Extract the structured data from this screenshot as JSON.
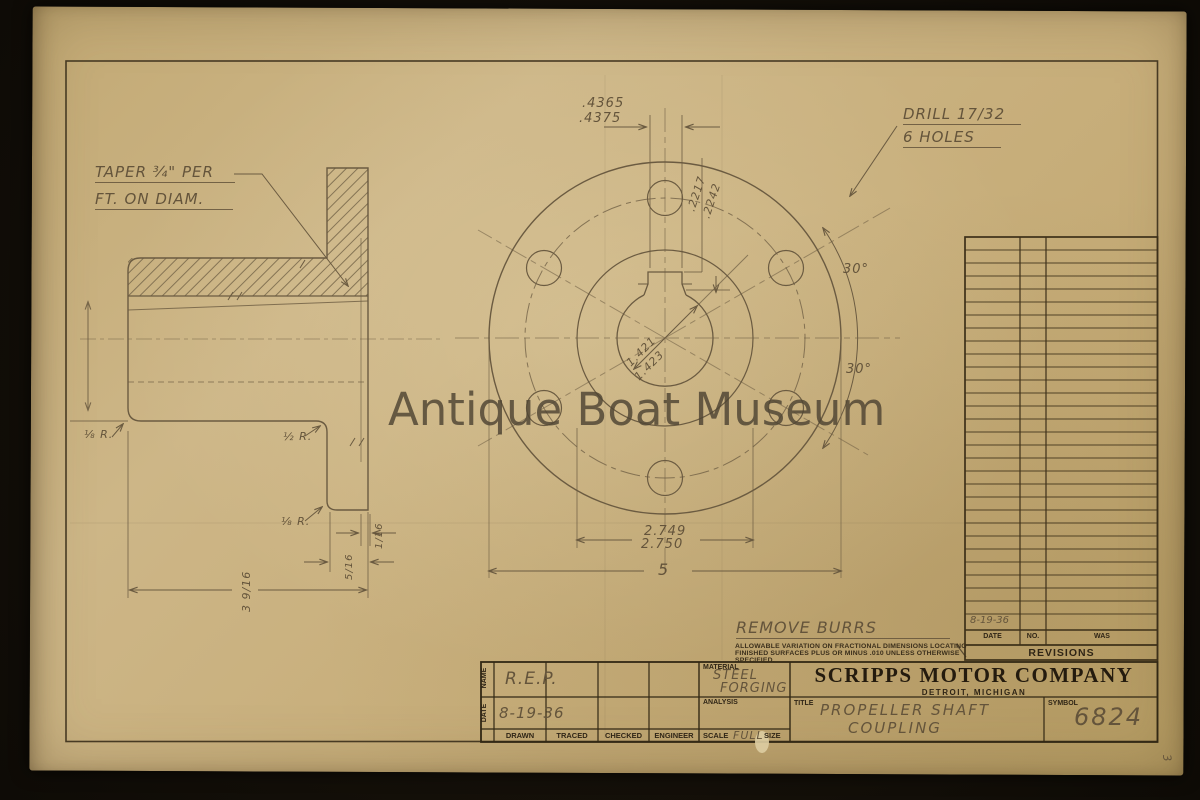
{
  "watermark": "Antique Boat Museum",
  "drawing": {
    "side_view": {
      "taper_note_line1": "TAPER ¾\" PER",
      "taper_note_line2": "FT. ON DIAM.",
      "radius_half": "½ R.",
      "radius_eighth": "⅛ R.",
      "radius_left": "⅛ R.",
      "dim_face": "1/16",
      "dim_flange": "5/16",
      "dim_length": "3 9/16"
    },
    "front_view": {
      "keyway_width_upper": ".4365",
      "keyway_width_lower": ".4375",
      "keyway_depth_upper": ".2217",
      "keyway_depth_lower": ".2242",
      "bore_upper": "1.421",
      "bore_lower": "1.423",
      "boss_upper": "2.749",
      "boss_lower": "2.750",
      "outside_diameter": "5",
      "angle_upper": "30°",
      "angle_lower": "30°",
      "drill_line1": "DRILL 17/32",
      "drill_line2": "6 HOLES"
    },
    "notes": {
      "remove_burrs": "REMOVE BURRS",
      "tolerance_line1": "ALLOWABLE VARIATION ON FRACTIONAL DIMENSIONS LOCATING",
      "tolerance_line2": "FINISHED SURFACES PLUS OR MINUS .010 UNLESS OTHERWISE",
      "tolerance_line3": "SPECIFIED."
    }
  },
  "revisions": {
    "title": "REVISIONS",
    "col_date": "DATE",
    "col_no": "NO.",
    "col_was": "WAS",
    "entry_date": "8-19-36"
  },
  "title_block": {
    "company": "SCRIPPS MOTOR COMPANY",
    "location": "DETROIT, MICHIGAN",
    "labels": {
      "name": "NAME",
      "date": "DATE",
      "material": "MATERIAL",
      "analysis": "ANALYSIS",
      "title": "TITLE",
      "symbol": "SYMBOL",
      "drawn": "DRAWN",
      "traced": "TRACED",
      "checked": "CHECKED",
      "engineer": "ENGINEER",
      "scale": "SCALE",
      "size": "SIZE"
    },
    "values": {
      "name": "R.E.P.",
      "date": "8-19-36",
      "material_line1": "STEEL",
      "material_line2": "FORGING",
      "scale": "FULL",
      "title_line1": "PROPELLER SHAFT",
      "title_line2": "COUPLING",
      "symbol": "6824"
    }
  },
  "page_number": "3"
}
